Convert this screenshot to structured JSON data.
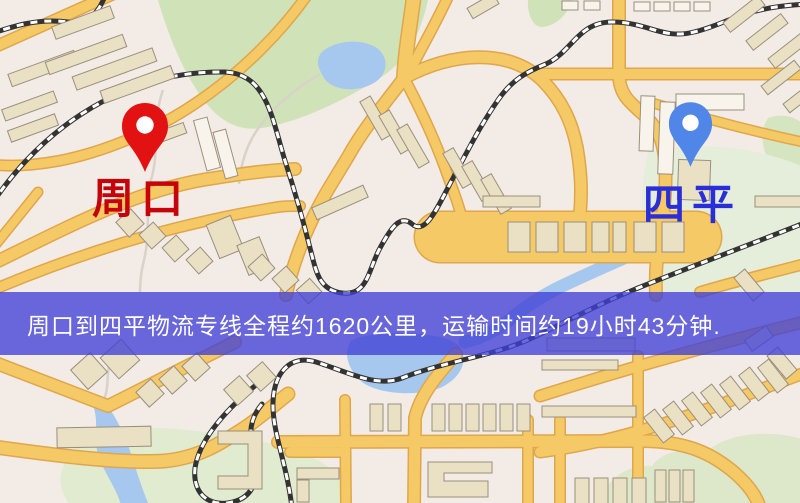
{
  "banner": {
    "text": "周口到四平物流专线全程约1620公里，运输时间约19小时43分钟.",
    "bg": "rgba(64,64,214,0.78)",
    "text_color": "#ffffff",
    "top": 292,
    "height": 63
  },
  "route_info": {
    "origin": "周口",
    "destination": "四平",
    "service": "物流专线",
    "distance_km": "1620",
    "duration": "19小时43分钟"
  },
  "markers": [
    {
      "id": "origin",
      "icon": "location-pin-icon",
      "label": "周口",
      "pin_color": "#e31212",
      "label_color": "#c50309",
      "tip_x": 145,
      "tip_y": 172,
      "pin_w": 48,
      "pin_h": 72,
      "label_x": 92,
      "label_y": 178
    },
    {
      "id": "destination",
      "icon": "location-pin-icon",
      "label": "四平",
      "pin_color": "#4f86e8",
      "label_color": "#2a2ed8",
      "tip_x": 690,
      "tip_y": 167,
      "pin_w": 45,
      "pin_h": 68,
      "label_x": 643,
      "label_y": 184
    }
  ],
  "map": {
    "colors": {
      "land": "#f3ece6",
      "park": "#cfe2b8",
      "park_pale": "#e0ebd0",
      "water": "#a6c8ee",
      "road_fill": "#f5c966",
      "road_edge": "#dfa64c",
      "rail": "#333333",
      "rail_dash": "#ffffff",
      "building_tan": "#eae0c4",
      "building_white": "#f8f4ec",
      "building_edge": "#9a8f7d",
      "trail": "#d9d2c9"
    },
    "greens": [
      {
        "d": "M 158,0 L 428,0 C 420,35 408,60 380,78 C 345,100 300,122 262,128 C 235,132 215,118 198,92 C 182,68 168,35 158,0 Z",
        "fill": "#cfe2b8"
      },
      {
        "d": "M 528,0 L 572,0 C 568,14 557,25 543,27 C 532,28 527,12 528,0 Z",
        "fill": "#cfe2b8"
      },
      {
        "d": "M 768,118 C 785,112 800,118 808,130 L 808,168 C 795,175 778,172 769,160 C 761,148 760,130 768,118 Z",
        "fill": "#d5e5bf"
      },
      {
        "d": "M 648,152 C 700,140 762,148 806,168 L 806,292 L 660,292 C 640,260 638,200 648,152 Z",
        "fill": "#e5eeda"
      },
      {
        "d": "M 62,470 C 70,440 110,425 160,428 C 230,432 300,445 330,468 C 345,480 345,495 340,505 L 70,505 C 62,495 58,482 62,470 Z",
        "fill": "#e0ebd0"
      },
      {
        "d": "M 598,505 C 606,478 628,464 652,466 C 662,452 684,446 702,456 C 720,436 756,430 790,436 L 806,440 L 806,505 Z",
        "fill": "#dde8ca"
      }
    ],
    "waters": [
      {
        "d": "M 322,52 C 335,40 362,38 377,48 C 390,58 388,76 372,84 C 355,93 332,90 324,78 C 318,68 315,60 322,52 Z"
      },
      {
        "d": "M 352,340 C 375,330 440,330 458,345 C 470,358 462,378 440,388 C 415,397 378,394 362,382 C 348,370 342,352 352,340 Z"
      },
      {
        "d": "M 93,405 C 100,425 92,442 100,460 C 107,477 117,490 121,505 L 149,505 C 141,487 136,468 129,448 C 123,430 114,415 106,403 Z"
      },
      {
        "d": "M 668,238 C 630,256 595,270 560,287 C 540,297 525,307 512,318 C 495,332 480,338 465,342",
        "stroke": 13
      }
    ],
    "trails": [
      {
        "d": "M 163,90 C 152,120 160,150 151,180 C 145,205 151,232 144,260 C 141,272 140,282 140,292"
      },
      {
        "d": "M 320,74 C 296,88 276,104 260,126 C 247,143 241,162 239,184"
      },
      {
        "d": "M 112,357 C 104,374 112,390 100,406"
      }
    ],
    "roads": [
      {
        "d": "M -12,50 L 122,-10",
        "w": 10
      },
      {
        "d": "M 415,-12 C 410,25 405,55 404,78",
        "w": 13
      },
      {
        "d": "M 452,-12 C 436,25 415,58 406,80",
        "w": 9
      },
      {
        "d": "M 404,78 C 452,52 508,48 542,80 C 562,100 572,122 577,148 C 581,172 582,190 580,214",
        "w": 11
      },
      {
        "d": "M 404,78 C 386,102 364,128 349,155 C 336,177 322,198 312,220 C 300,245 292,268 286,295",
        "w": 11
      },
      {
        "d": "M 404,78 C 420,108 434,138 445,168 C 452,188 458,202 461,215",
        "w": 9
      },
      {
        "d": "M -12,266 C 70,226 140,188 215,178 C 248,173 270,170 295,169",
        "w": 11
      },
      {
        "d": "M 312,-12 C 284,30 242,72 196,103 C 152,133 100,153 58,161 C 30,166 8,167 -12,164",
        "w": 9
      },
      {
        "d": "M -12,292 C 75,255 165,226 272,208 C 282,206 290,206 300,206",
        "w": 9
      },
      {
        "d": "M 38,192 L -12,254",
        "w": 8
      },
      {
        "d": "M 440,237 L 696,237",
        "w": 50
      },
      {
        "d": "M 619,-12 L 619,74 C 619,108 650,108 661,140 C 668,162 666,196 661,228 C 657,252 655,272 656,295",
        "w": 11
      },
      {
        "d": "M 538,74 L 812,74",
        "w": 10
      },
      {
        "d": "M 656,104 C 702,118 755,132 812,144",
        "w": 8
      },
      {
        "d": "M 700,292 C 740,280 775,272 812,262",
        "w": 9
      },
      {
        "d": "M -12,360 L 108,406 L 235,342",
        "w": 11
      },
      {
        "d": "M -12,446 C 45,454 118,464 164,461 C 198,458 220,444 246,427 C 262,416 274,405 288,394",
        "w": 12
      },
      {
        "d": "M 456,354 C 436,376 420,396 415,418 L 414,508",
        "w": 11
      },
      {
        "d": "M 278,442 L 640,441 C 686,441 712,453 736,474 C 748,485 756,495 760,508",
        "w": 11
      },
      {
        "d": "M 540,396 C 622,370 706,346 812,320",
        "w": 10
      },
      {
        "d": "M 540,452 C 634,440 722,404 812,370",
        "w": 10
      },
      {
        "d": "M 528,420 L 528,508",
        "w": 9
      },
      {
        "d": "M 638,356 L 638,508",
        "w": 9
      },
      {
        "d": "M 560,420 L 560,508",
        "w": 9
      },
      {
        "d": "M 290,452 L 345,452",
        "w": 9
      },
      {
        "d": "M 345,400 L 346,508",
        "w": 9
      }
    ],
    "rails": [
      {
        "d": "M -15,215 C 30,140 115,70 225,72 C 268,74 272,120 286,164 C 295,192 303,220 310,248 C 316,270 318,290 342,293 C 368,296 368,270 380,248 C 391,228 400,214 412,224 C 426,236 438,206 452,180 C 468,150 480,126 498,100 C 512,80 526,72 546,64 C 572,52 578,22 612,22 C 648,22 662,40 694,32 C 728,24 744,6 812,4"
      },
      {
        "d": "M -10,34 C 14,26 38,18 68,22 C 88,25 98,14 106,-6"
      },
      {
        "d": "M 812,220 C 744,247 690,267 638,288 C 596,305 566,322 532,338 C 494,356 442,362 402,378 C 376,388 348,372 316,362 C 290,354 274,373 273,402 C 272,432 287,464 292,508"
      },
      {
        "d": "M 262,380 C 232,404 200,436 195,468 C 192,496 212,509 236,501 C 258,494 260,468 253,446 C 248,430 252,416 262,404"
      }
    ],
    "buildings": [
      [
        8,
        62,
        70,
        13,
        -20,
        "t"
      ],
      [
        45,
        48,
        82,
        13,
        -20,
        "t"
      ],
      [
        72,
        62,
        85,
        14,
        -20,
        "t"
      ],
      [
        100,
        78,
        75,
        13,
        -20,
        "t"
      ],
      [
        2,
        100,
        55,
        12,
        -20,
        "t"
      ],
      [
        8,
        122,
        50,
        12,
        -20,
        "t"
      ],
      [
        52,
        16,
        62,
        13,
        -20,
        "t"
      ],
      [
        200,
        118,
        14,
        52,
        -15,
        "w"
      ],
      [
        219,
        130,
        13,
        48,
        -15,
        "w"
      ],
      [
        152,
        128,
        34,
        11,
        -20,
        "t"
      ],
      [
        120,
        213,
        20,
        20,
        -42,
        "t"
      ],
      [
        143,
        226,
        19,
        19,
        -42,
        "t"
      ],
      [
        166,
        239,
        19,
        19,
        -42,
        "t"
      ],
      [
        190,
        251,
        19,
        19,
        -42,
        "t"
      ],
      [
        212,
        219,
        26,
        36,
        -22,
        "t"
      ],
      [
        242,
        240,
        24,
        32,
        -22,
        "t"
      ],
      [
        252,
        258,
        19,
        19,
        -42,
        "t"
      ],
      [
        276,
        270,
        19,
        19,
        -42,
        "t"
      ],
      [
        300,
        282,
        18,
        18,
        -42,
        "t"
      ],
      [
        370,
        96,
        12,
        44,
        -30,
        "t"
      ],
      [
        389,
        110,
        12,
        44,
        -30,
        "t"
      ],
      [
        407,
        124,
        12,
        44,
        -30,
        "t"
      ],
      [
        452,
        148,
        12,
        40,
        -30,
        "t"
      ],
      [
        471,
        161,
        12,
        40,
        -30,
        "t"
      ],
      [
        490,
        174,
        12,
        40,
        -30,
        "t"
      ],
      [
        312,
        196,
        56,
        13,
        -24,
        "t"
      ],
      [
        483,
        196,
        57,
        11,
        0,
        "t"
      ],
      [
        755,
        196,
        50,
        11,
        0,
        "t"
      ],
      [
        508,
        222,
        22,
        30,
        0,
        "t"
      ],
      [
        536,
        222,
        22,
        30,
        0,
        "t"
      ],
      [
        564,
        222,
        22,
        30,
        0,
        "t"
      ],
      [
        592,
        222,
        17,
        30,
        0,
        "t"
      ],
      [
        613,
        222,
        13,
        30,
        0,
        "t"
      ],
      [
        634,
        222,
        22,
        30,
        0,
        "t"
      ],
      [
        662,
        222,
        22,
        30,
        0,
        "t"
      ],
      [
        468,
        0,
        30,
        12,
        -30,
        "t"
      ],
      [
        562,
        1,
        16,
        9,
        0,
        "w"
      ],
      [
        584,
        1,
        16,
        9,
        0,
        "w"
      ],
      [
        634,
        2,
        16,
        9,
        0,
        "w"
      ],
      [
        654,
        2,
        16,
        9,
        0,
        "w"
      ],
      [
        674,
        2,
        16,
        9,
        0,
        "w"
      ],
      [
        694,
        2,
        16,
        9,
        0,
        "w"
      ],
      [
        640,
        96,
        14,
        55,
        2,
        "w"
      ],
      [
        659,
        102,
        15,
        72,
        2,
        "w"
      ],
      [
        676,
        94,
        68,
        16,
        0,
        "w"
      ],
      [
        678,
        160,
        32,
        40,
        2,
        "t"
      ],
      [
        722,
        8,
        44,
        12,
        -38,
        "t"
      ],
      [
        745,
        26,
        44,
        12,
        -38,
        "t"
      ],
      [
        767,
        44,
        44,
        12,
        -38,
        "t"
      ],
      [
        760,
        72,
        42,
        11,
        -38,
        "t"
      ],
      [
        782,
        90,
        42,
        11,
        -38,
        "t"
      ],
      [
        742,
        270,
        14,
        30,
        -40,
        "t"
      ],
      [
        57,
        427,
        94,
        20,
        -1,
        "t"
      ],
      [
        76,
        358,
        26,
        26,
        -42,
        "t"
      ],
      [
        106,
        345,
        28,
        28,
        -42,
        "t"
      ],
      [
        140,
        383,
        20,
        20,
        -42,
        "t"
      ],
      [
        163,
        370,
        20,
        20,
        -42,
        "t"
      ],
      [
        186,
        357,
        20,
        20,
        -42,
        "t"
      ],
      [
        228,
        380,
        21,
        21,
        -42,
        "t"
      ],
      [
        251,
        366,
        21,
        21,
        -42,
        "t"
      ],
      {
        "d": "M 218,431 H 262 V 489 H 218 V 476 H 248 V 444 H 218 Z",
        "theme": "t"
      },
      [
        370,
        404,
        13,
        27,
        0,
        "t"
      ],
      [
        388,
        404,
        13,
        27,
        0,
        "t"
      ],
      [
        432,
        404,
        13,
        27,
        0,
        "t"
      ],
      [
        449,
        404,
        13,
        27,
        0,
        "t"
      ],
      [
        466,
        404,
        13,
        27,
        0,
        "t"
      ],
      [
        483,
        404,
        13,
        27,
        0,
        "t"
      ],
      [
        500,
        404,
        13,
        27,
        0,
        "t"
      ],
      [
        517,
        404,
        13,
        27,
        0,
        "t"
      ],
      [
        297,
        468,
        42,
        11,
        0,
        "t"
      ],
      [
        297,
        480,
        12,
        22,
        0,
        "t"
      ],
      {
        "d": "M 428,462 H 492 V 473 H 444 V 481 H 488 V 497 H 428 Z",
        "theme": "t"
      },
      [
        655,
        470,
        11,
        32,
        0,
        "t"
      ],
      [
        669,
        470,
        11,
        32,
        0,
        "t"
      ],
      [
        683,
        470,
        11,
        32,
        0,
        "t"
      ],
      [
        575,
        478,
        14,
        30,
        0,
        "t"
      ],
      [
        594,
        478,
        14,
        30,
        0,
        "t"
      ],
      [
        613,
        478,
        14,
        30,
        0,
        "t"
      ],
      [
        632,
        478,
        14,
        30,
        0,
        "t"
      ],
      [
        547,
        338,
        88,
        13,
        0,
        "t"
      ],
      [
        542,
        360,
        76,
        10,
        0,
        "t"
      ],
      [
        542,
        406,
        94,
        11,
        0,
        "t"
      ],
      [
        652,
        410,
        14,
        32,
        -38,
        "t"
      ],
      [
        671,
        402,
        14,
        32,
        -38,
        "t"
      ],
      [
        690,
        393,
        14,
        32,
        -38,
        "t"
      ],
      [
        709,
        385,
        14,
        32,
        -38,
        "t"
      ],
      [
        728,
        377,
        14,
        32,
        -38,
        "t"
      ],
      [
        747,
        368,
        14,
        32,
        -38,
        "t"
      ],
      [
        766,
        360,
        14,
        32,
        -38,
        "t"
      ],
      [
        775,
        348,
        14,
        30,
        -40,
        "t"
      ],
      [
        746,
        332,
        26,
        13,
        -35,
        "t"
      ]
    ]
  }
}
